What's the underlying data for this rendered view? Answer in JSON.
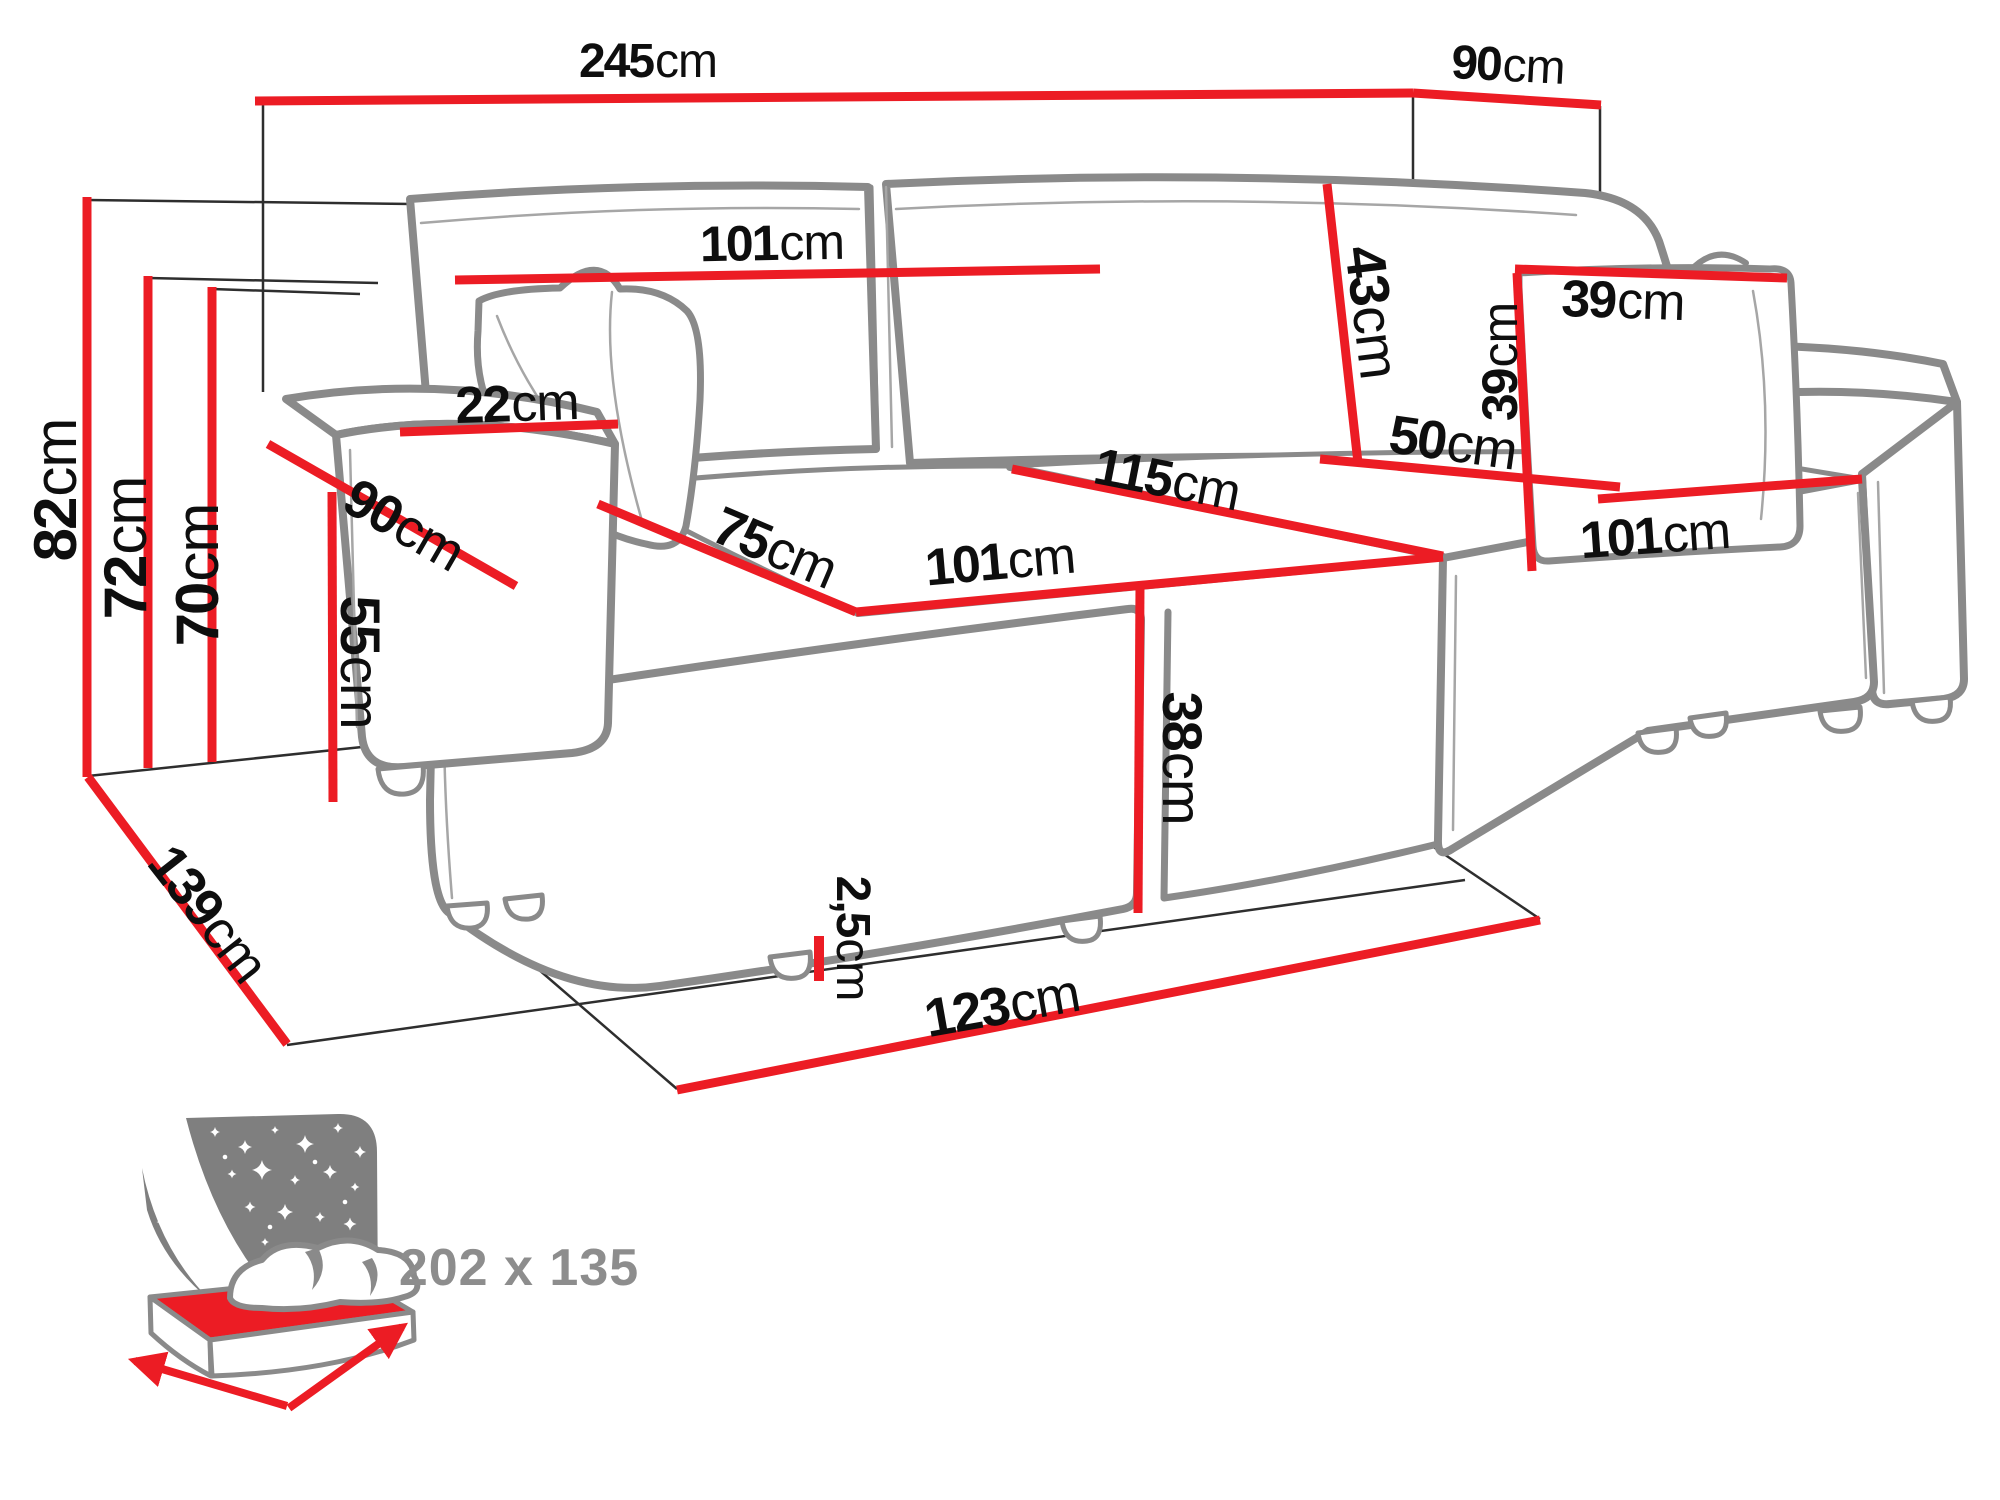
{
  "diagram": {
    "background": "#ffffff",
    "colors": {
      "dimension_line": "#ec1c24",
      "sofa_outline": "#8a8a8a",
      "construction_line": "#2e2e2e",
      "label_text": "#0e0e0e",
      "icon_gray": "#7f7f7f",
      "icon_text": "#8d8d8d"
    },
    "dimensions": {
      "total_width": {
        "value": "245",
        "unit": "cm"
      },
      "total_depth_right": {
        "value": "90",
        "unit": "cm"
      },
      "total_height": {
        "value": "82",
        "unit": "cm"
      },
      "backrest_height": {
        "value": "72",
        "unit": "cm"
      },
      "back_cushion_top_height": {
        "value": "70",
        "unit": "cm"
      },
      "backrest_width": {
        "value": "101",
        "unit": "cm"
      },
      "armrest_top_width": {
        "value": "22",
        "unit": "cm"
      },
      "armrest_depth": {
        "value": "90",
        "unit": "cm"
      },
      "armrest_height": {
        "value": "55",
        "unit": "cm"
      },
      "seat_depth": {
        "value": "75",
        "unit": "cm"
      },
      "seat_front_width": {
        "value": "101",
        "unit": "cm"
      },
      "chaise_diagonal_width": {
        "value": "115",
        "unit": "cm"
      },
      "back_cushion_height": {
        "value": "43",
        "unit": "cm"
      },
      "chaise_back_width": {
        "value": "50",
        "unit": "cm"
      },
      "pillow_width": {
        "value": "39",
        "unit": "cm"
      },
      "pillow_height": {
        "value": "39",
        "unit": "cm"
      },
      "chaise_side_length": {
        "value": "101",
        "unit": "cm"
      },
      "seat_front_height": {
        "value": "38",
        "unit": "cm"
      },
      "leg_height": {
        "value": "2,5",
        "unit": "cm"
      },
      "front_panel_width": {
        "value": "123",
        "unit": "cm"
      },
      "total_side_depth": {
        "value": "139",
        "unit": "cm"
      }
    },
    "bed_icon": {
      "sleeping_area": "202 x 135"
    }
  }
}
